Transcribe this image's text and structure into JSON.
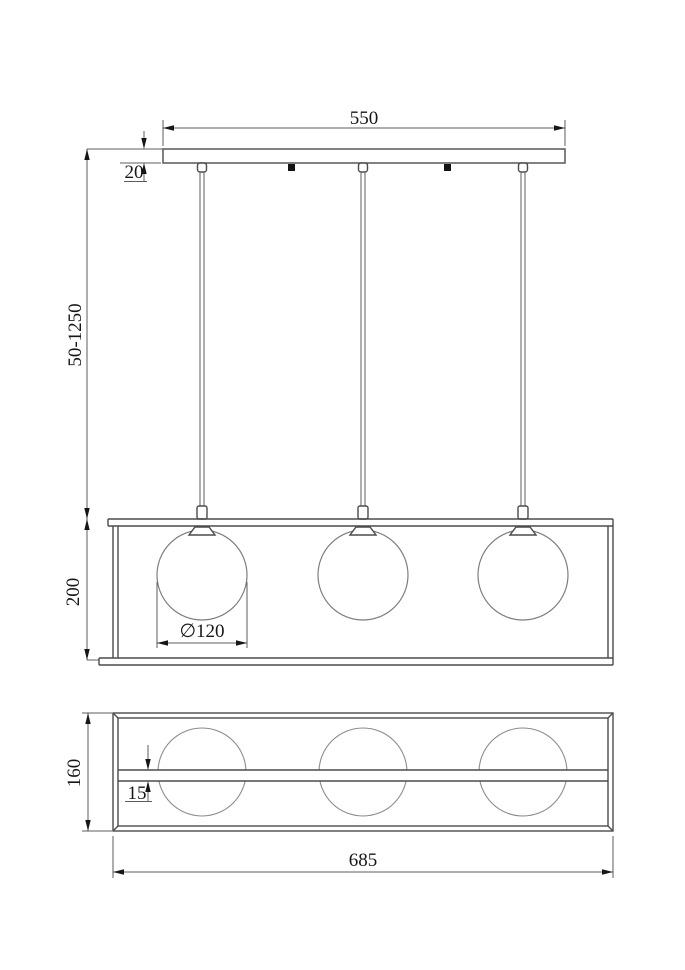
{
  "page": {
    "background": "#ffffff",
    "line_color": "#4b4b4b",
    "text_color": "#161616"
  },
  "dimensions": {
    "canopy_width": "550",
    "canopy_thickness": "20",
    "suspension_range": "50-1250",
    "frame_height": "200",
    "globe_diameter": "∅120",
    "frame_depth": "160",
    "rail_width": "15",
    "frame_length": "685"
  }
}
